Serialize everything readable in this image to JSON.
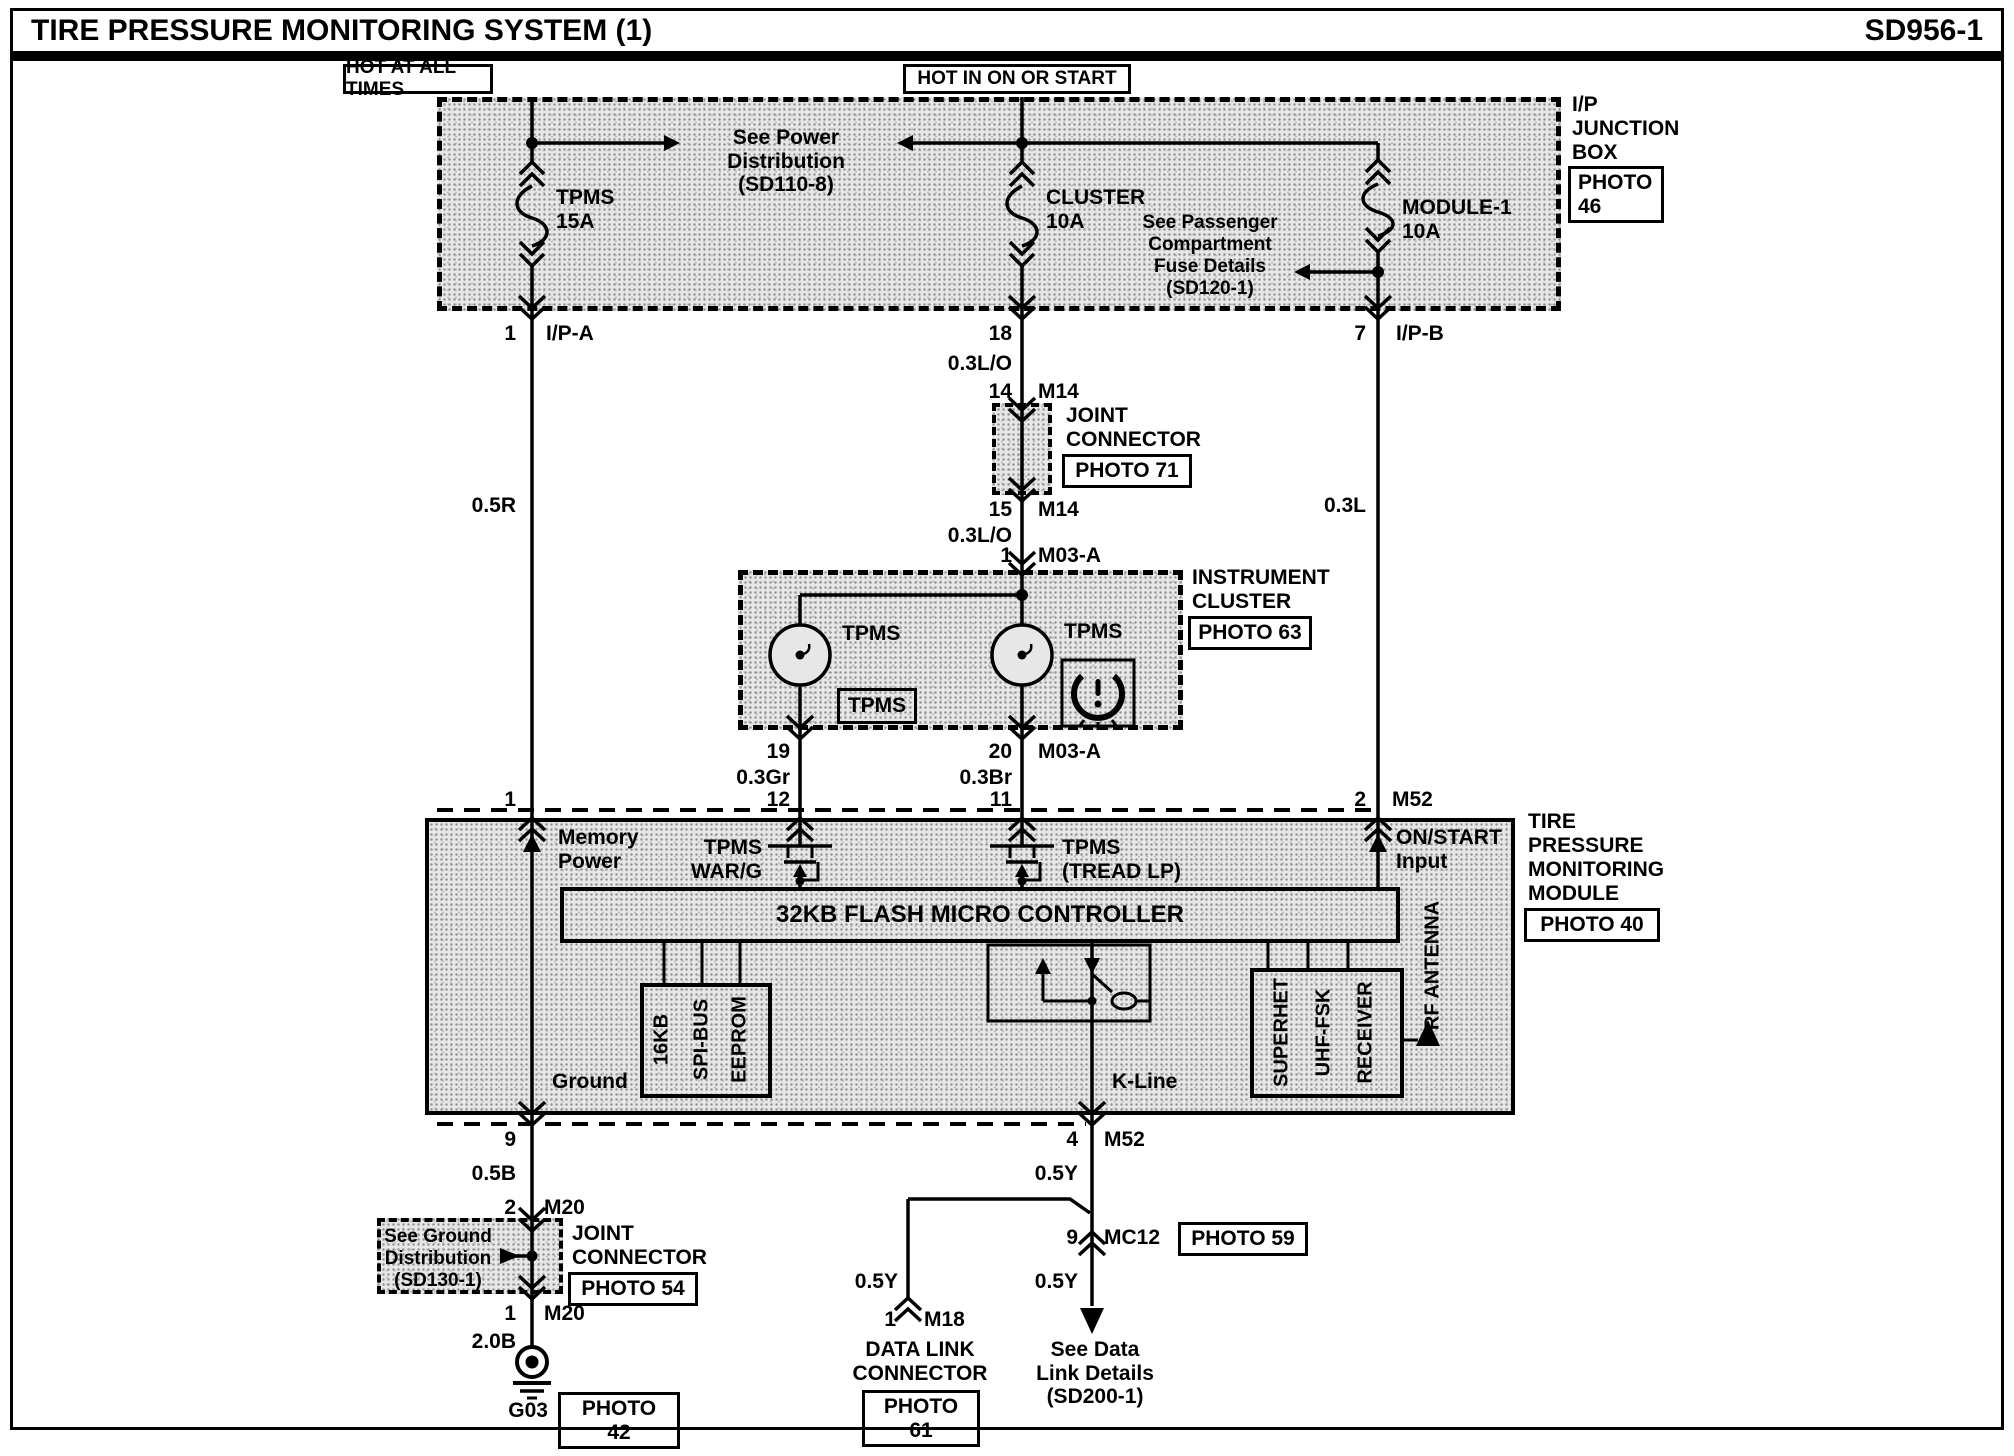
{
  "header": {
    "title": "TIRE PRESSURE MONITORING SYSTEM (1)",
    "code": "SD956-1"
  },
  "power": {
    "hot_all": "HOT AT ALL TIMES",
    "hot_on": "HOT IN ON OR START",
    "see_power_1": "See Power Distribution",
    "see_power_2": "(SD110-8)",
    "see_pass_1": "See Passenger",
    "see_pass_2": "Compartment",
    "see_pass_3": "Fuse Details",
    "see_pass_4": "(SD120-1)"
  },
  "ip_box": {
    "name_1": "I/P",
    "name_2": "JUNCTION",
    "name_3": "BOX",
    "photo_1": "PHOTO",
    "photo_2": "46"
  },
  "fuses": {
    "f1_name": "TPMS",
    "f1_rating": "15A",
    "f2_name": "CLUSTER",
    "f2_rating": "10A",
    "f3_name": "MODULE-1",
    "f3_rating": "10A"
  },
  "left_branch": {
    "pin": "1",
    "conn": "I/P-A",
    "wire": "0.5R",
    "module_pin": "1"
  },
  "mid_branch": {
    "pin18": "18",
    "wire1": "0.3L/O",
    "pin14": "14",
    "conn14": "M14",
    "jc_1": "JOINT",
    "jc_2": "CONNECTOR",
    "jc_photo": "PHOTO 71",
    "pin15": "15",
    "conn15": "M14",
    "wire2": "0.3L/O",
    "pin1": "1",
    "conn1": "M03-A"
  },
  "right_branch": {
    "pin": "7",
    "conn": "I/P-B",
    "wire": "0.3L",
    "module_pin": "2",
    "module_conn": "M52"
  },
  "cluster": {
    "name_1": "INSTRUMENT",
    "name_2": "CLUSTER",
    "photo": "PHOTO 63",
    "lamp1": "TPMS",
    "lamp2": "TPMS",
    "telltale": "TPMS",
    "pin19": "19",
    "pin20": "20",
    "conn20": "M03-A",
    "wire19": "0.3Gr",
    "wire20": "0.3Br",
    "module_pin12": "12",
    "module_pin11": "11"
  },
  "module": {
    "name_1": "TIRE",
    "name_2": "PRESSURE",
    "name_3": "MONITORING",
    "name_4": "MODULE",
    "photo": "PHOTO 40",
    "mem_1": "Memory",
    "mem_2": "Power",
    "warg_1": "TPMS",
    "warg_2": "WAR/G",
    "tread_1": "TPMS",
    "tread_2": "(TREAD LP)",
    "onstart_1": "ON/START",
    "onstart_2": "Input",
    "mcu": "32KB FLASH MICRO CONTROLLER",
    "eeprom_1": "16KB",
    "eeprom_2": "SPI-BUS",
    "eeprom_3": "EEPROM",
    "rx_1": "SUPERHET",
    "rx_2": "UHF-FSK",
    "rx_3": "RECEIVER",
    "antenna": "RF ANTENNA",
    "ground": "Ground",
    "kline": "K-Line"
  },
  "ground_branch": {
    "pin9": "9",
    "wire1": "0.5B",
    "pin2": "2",
    "conn2": "M20",
    "jc_1": "JOINT",
    "jc_2": "CONNECTOR",
    "jc_photo": "PHOTO 54",
    "see_1": "See Ground",
    "see_2": "Distribution",
    "see_3": "(SD130-1)",
    "pin1": "1",
    "conn1": "M20",
    "wire2": "2.0B",
    "gnd": "G03",
    "gnd_photo": "PHOTO 42"
  },
  "kline_branch": {
    "pin4": "4",
    "conn4": "M52",
    "wire1": "0.5Y",
    "pin9": "9",
    "conn9": "MC12",
    "photo59": "PHOTO 59",
    "wire2": "0.5Y",
    "wire3": "0.5Y",
    "pin1": "1",
    "conn1": "M18",
    "dlc_1": "DATA LINK",
    "dlc_2": "CONNECTOR",
    "dlc_photo": "PHOTO 61",
    "see_1": "See Data",
    "see_2": "Link Details",
    "see_3": "(SD200-1)"
  }
}
